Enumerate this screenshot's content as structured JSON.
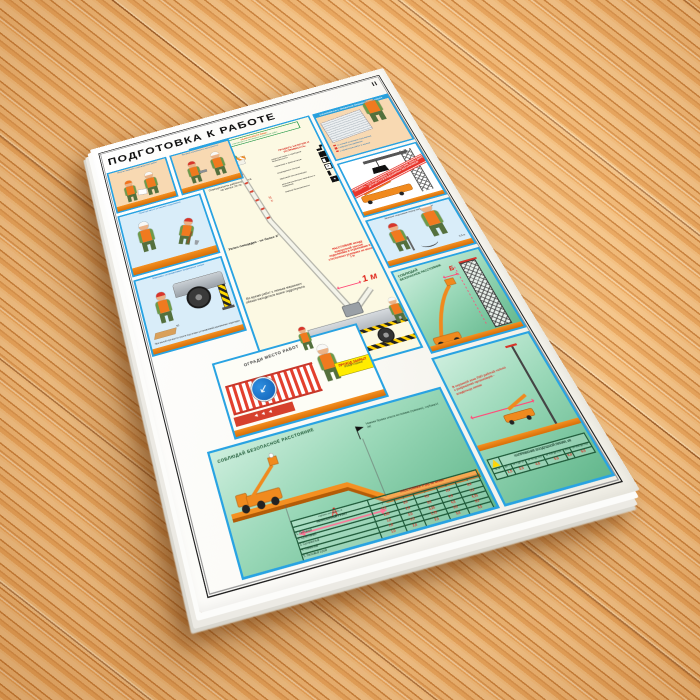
{
  "poster": {
    "title": "ПОДГОТОВКА К РАБОТЕ",
    "sheet_number": "II"
  },
  "left_panels": {
    "task": {
      "caption": "Получи задание у руководителя работ"
    },
    "tools": {
      "caption": "Проверь исправность инструмента"
    },
    "site": {
      "caption": "Осмотри место установки подъемника"
    },
    "outriggers": {
      "caption": "Машинист устанавливает выдвижные опоры",
      "note": "При малой прочности грунта под опоры устанавливай деревянные подкладки",
      "dim": "50"
    }
  },
  "fence": {
    "heading": "ОГРАДИ МЕСТО РАБОТ",
    "sign_line1": "ПРОХОД ЗАКРЫТ",
    "sign_line2": "обойди стороной",
    "chevrons": "◄◄◄"
  },
  "center": {
    "duties_line1": "ОБЯЗАННОСТИ ЛИЦА,",
    "duties_line2": "отвечающего за безопасное выполнение работ",
    "lighting": "Освещенность рабочего места не менее 20 лк",
    "slope": "Уклон площадки - не более 3°",
    "operator_note": "Во время работ с люльки машинист обязан находиться возле гидропульта",
    "boom_mark": "30 м",
    "check_header": "ПРОВЕРЬ НАЛИЧИЕ И ИСПРАВНОСТЬ:",
    "check_items": [
      {
        "label": "гидросистемы и приборов безопасности",
        "icon": "wrench-icon"
      },
      {
        "label": "тормозов и фиксаторов",
        "icon": "block-icon"
      },
      {
        "label": "ограждения люльки",
        "icon": "door-icon"
      },
      {
        "label": "звуковой сигнализации",
        "icon": "frame-icon"
      },
      {
        "label": "диэлектрических перчаток и ковриков",
        "icon": "gloves-icon"
      },
      {
        "label": "знаков безопасности",
        "icon": "sign-icon"
      }
    ],
    "distance_note": "РАССТОЯНИЕ между поворотной частью подъемника и строениями в стесненных условиях не менее 1 м",
    "distance_value": "1 м"
  },
  "right_panels": {
    "briefing": {
      "header": "ОЗНАКОМЬСЯ С ПРОЕКТОМ ПРОИЗВОДСТВА РАБОТ",
      "items": [
        "со схемой установки подъемника",
        "с маршрутом движения",
        "с характером работ в люльке"
      ]
    },
    "crane_zone": {
      "banner": "УБЕДИСЬ, ЧТО ПОДЪЕМНИК УСТАНОВЛЕН ВНЕ ЗОНЫ ДЕЙСТВИЯ ДРУГИХ ГРУЗОПОДЪЕМНЫХ МЕХАНИЗМОВ"
    },
    "grounding": {
      "caption": "Заземли подъемник перед началом работ",
      "dim": "0,5 м"
    },
    "safe_distance": {
      "header_line1": "СОБЛЮДАЙ",
      "header_line2": "БЕЗОПАСНОЕ РАССТОЯНИЕ",
      "letter": "Б"
    }
  },
  "bottom_left": {
    "header": "СОБЛЮДАЙ БЕЗОПАСНОЕ РАССТОЯНИЕ",
    "flag_note": "Нижняя бровка откоса котлована (траншеи), глубина Н (м)",
    "letter": "А",
    "table": {
      "corner_label": "НЕНАСЫПНОЙ ГРУНТ",
      "header": "РАССТОЯНИЕ А (м), не менее",
      "depth_label": "глубина котлована, м",
      "depths": [
        "1",
        "2",
        "3",
        "4",
        "5"
      ],
      "rows": [
        {
          "soil": "1. Песчаный",
          "values": [
            "1,5",
            "3,0",
            "4,0",
            "5,0",
            "6,0"
          ]
        },
        {
          "soil": "2. Супесчаный",
          "values": [
            "1,25",
            "2,4",
            "3,6",
            "4,4",
            "5,3"
          ]
        },
        {
          "soil": "3. Суглинистый",
          "values": [
            "1,0",
            "2,0",
            "3,25",
            "4,0",
            "4,75"
          ]
        },
        {
          "soil": "4. Глинистый",
          "values": [
            "1,0",
            "1,5",
            "1,75",
            "3,0",
            "3,5"
          ]
        },
        {
          "soil": "5. Лессовый сухой",
          "values": [
            "1,0",
            "2,0",
            "2,5",
            "3,0",
            "3,5"
          ]
        }
      ]
    }
  },
  "bottom_right": {
    "warning": "В охранной зоне ЛЭП работай только с разрешения организации - владельца линии",
    "table": {
      "header": "НАПРЯЖЕНИЕ ВОЗДУШНОЙ ЛИНИИ, кВ",
      "row_label": "Б, м",
      "cols": [
        "До 1",
        "от 1 до 20",
        "от 35 до 110",
        "от 150 до 220",
        "330",
        "от 500 до 750"
      ],
      "values": [
        "1,5",
        "2,0",
        "4,0",
        "5,0",
        "6,0",
        "9,0"
      ]
    }
  },
  "colors": {
    "panel_border_blue": "#29a3e2",
    "warning_red": "#e0251b",
    "safety_orange": "#f08a1e",
    "panel_green": "#8ecfae",
    "sign_yellow": "#ffec00"
  }
}
